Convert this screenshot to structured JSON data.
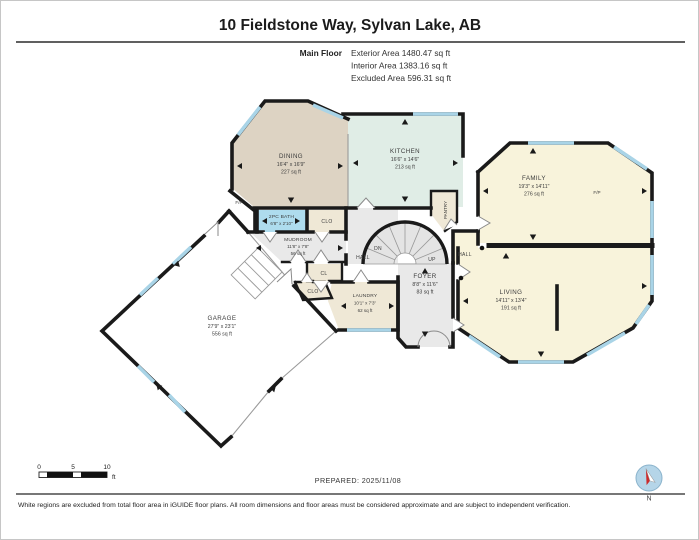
{
  "page": {
    "title": "10 Fieldstone Way, Sylvan Lake, AB",
    "floor_label": "Main Floor",
    "stats": {
      "exterior": "Exterior Area 1480.47 sq ft",
      "interior": "Interior Area 1383.16 sq ft",
      "excluded": "Excluded Area 596.31 sq ft"
    },
    "prepared": "PREPARED: 2025/11/08",
    "disclaimer": "White regions are excluded from total floor area in iGUIDE floor plans. All room dimensions and floor areas must be considered approximate and are subject to independent verification.",
    "compass": "N"
  },
  "scale_bar": {
    "t0": "0",
    "t5": "5",
    "t10": "10",
    "unit": "ft"
  },
  "rooms": {
    "dining": {
      "name": "DINING",
      "dims": "16'4\" x 16'9\"",
      "area": "227 sq ft"
    },
    "kitchen": {
      "name": "KITCHEN",
      "dims": "16'6\" x 14'6\"",
      "area": "213 sq ft"
    },
    "family": {
      "name": "FAMILY",
      "dims": "19'3\" x 14'11\"",
      "area": "276 sq ft"
    },
    "living": {
      "name": "LIVING",
      "dims": "14'11\" x 13'4\"",
      "area": "191 sq ft"
    },
    "foyer": {
      "name": "FOYER",
      "dims": "8'8\" x 11'6\"",
      "area": "83 sq ft"
    },
    "mudroom": {
      "name": "MUDROOM",
      "dims": "11'8\" x 7'8\"",
      "area": "56 sq ft"
    },
    "laundry": {
      "name": "LAUNDRY",
      "dims": "10'1\" x 7'3\"",
      "area": "62 sq ft"
    },
    "garage": {
      "name": "GARAGE",
      "dims": "27'9\" x 23'1\"",
      "area": "556 sq ft"
    },
    "bath": {
      "name": "2PC BATH",
      "dims": "6'8\" x 2'10\""
    }
  },
  "labels": {
    "clo_top": "CLO",
    "cl": "CL",
    "clo_bottom": "CLO",
    "hall_left": "HALL",
    "hall_right": "HALL",
    "pantry": "PANTRY",
    "down": "DN",
    "up": "UP",
    "fp_dining": "F/P",
    "fp_family": "F/P"
  },
  "colors": {
    "wall": "#1a1a1a",
    "window": "#a9d4e7",
    "dining": "#ddd3c3",
    "kitchen": "#e0ede6",
    "family_living": "#f8f3db",
    "bath": "#aedcee",
    "hall": "#e9e9e9",
    "closet": "#efe8d6",
    "compass_fill": "#b5d5e8",
    "compass_needle": "#cc2a2a"
  }
}
